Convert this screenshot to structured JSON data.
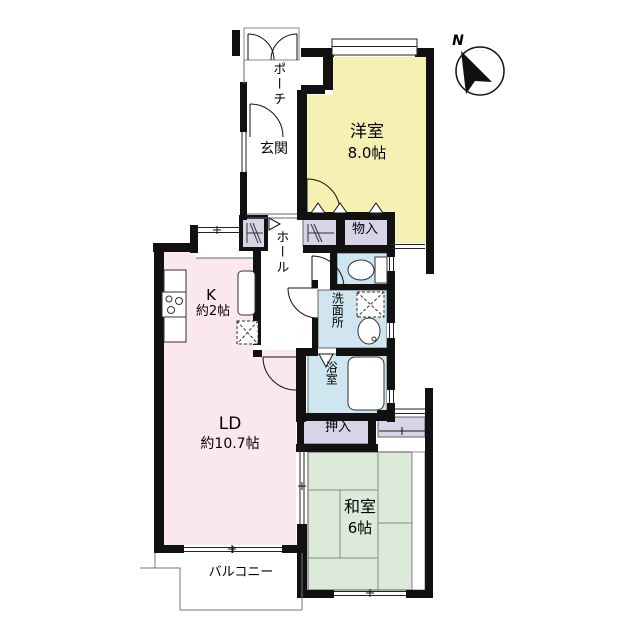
{
  "title": "間取り図",
  "compass": {
    "label": "N",
    "direction": "north-west-up"
  },
  "rooms": {
    "porch": {
      "label": "ポーチ"
    },
    "entrance": {
      "label": "玄関"
    },
    "western_room": {
      "label": "洋室",
      "size": "8.0帖"
    },
    "hall": {
      "label": "ホール"
    },
    "storage": {
      "label": "物入"
    },
    "toilet": {
      "label": ""
    },
    "washroom": {
      "label": "洗面所"
    },
    "bathroom": {
      "label": "浴室"
    },
    "kitchen": {
      "label": "K",
      "size": "約2帖"
    },
    "living_dining": {
      "label": "LD",
      "size": "約10.7帖"
    },
    "closet": {
      "label": "押入"
    },
    "japanese_room": {
      "label": "和室",
      "size": "6帖"
    },
    "balcony": {
      "label": "バルコニー"
    }
  },
  "colors": {
    "western_room_fill": "#f6f1b2",
    "living_dining_fill": "#fbe7ee",
    "japanese_room_fill": "#dcead9",
    "closet_fill": "#d7d4e8",
    "wet_area_fill": "#cfe6f0",
    "wall": "#111111",
    "background": "#ffffff"
  }
}
